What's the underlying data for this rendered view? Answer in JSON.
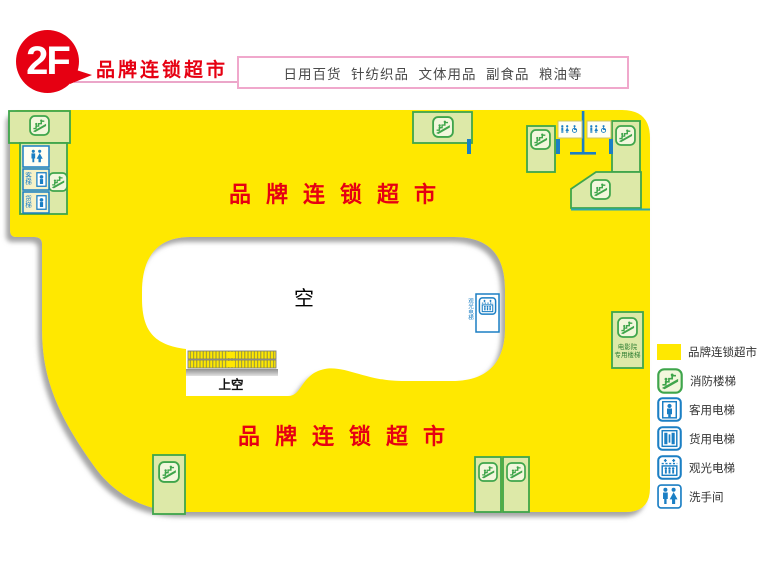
{
  "header": {
    "floor": "2F",
    "title": "品牌连锁超市",
    "categories": "日用百货  针纺织品  文体用品  副食品  粮油等"
  },
  "map": {
    "area_label_top": "品牌连锁超市",
    "area_label_bottom": "品牌连锁超市",
    "void_label": "空",
    "void_upper_label": "上空",
    "cinema_label_1": "电影院",
    "cinema_label_2": "专用楼梯",
    "sightseeing_label": "观光电梯",
    "passenger_short": "客梯",
    "freight_short": "货梯"
  },
  "legend": {
    "items": [
      {
        "label": "品牌连锁超市",
        "icon": "area-swatch",
        "color": "#ffe800"
      },
      {
        "label": "消防楼梯",
        "icon": "fire-stairs-icon"
      },
      {
        "label": "客用电梯",
        "icon": "passenger-elevator-icon"
      },
      {
        "label": "货用电梯",
        "icon": "freight-elevator-icon"
      },
      {
        "label": "观光电梯",
        "icon": "sightseeing-elevator-icon"
      },
      {
        "label": "洗手间",
        "icon": "toilet-icon"
      }
    ]
  },
  "colors": {
    "area_fill": "#ffe800",
    "room_fill": "#dde9a8",
    "room_border": "#3fa54b",
    "icon_blue": "#1b7fc4",
    "accent_red": "#e60012",
    "pink_border": "#f0a8cc"
  }
}
